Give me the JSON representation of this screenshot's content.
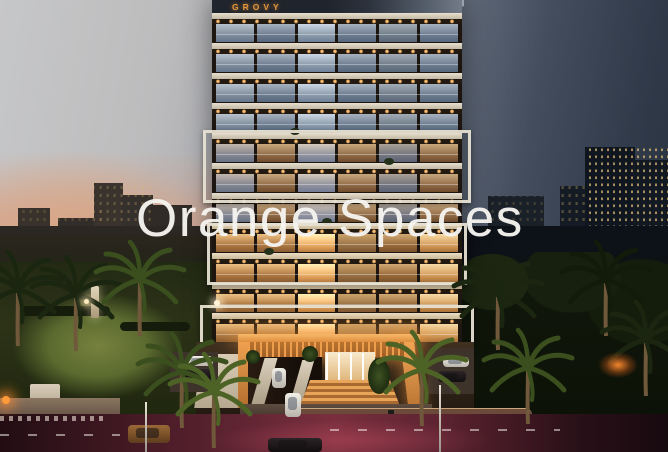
{
  "scene": {
    "description": "Dusk architectural rendering of a residential tower with watermark",
    "watermark": {
      "text": "Orange Spaces",
      "color": "#f6f4f0"
    },
    "building": {
      "sign_text": "GROVY",
      "sign_color": "#e5973c",
      "floor_count": 11,
      "floors": [
        {
          "tone": "cool"
        },
        {
          "tone": "cool"
        },
        {
          "tone": "cool"
        },
        {
          "tone": "cool"
        },
        {
          "tone": "mixed"
        },
        {
          "tone": "mixed"
        },
        {
          "tone": "mixed"
        },
        {
          "tone": "warm"
        },
        {
          "tone": "warm"
        },
        {
          "tone": "warm"
        },
        {
          "tone": "warm"
        }
      ]
    },
    "palette": {
      "sky_light": "#c6c7c9",
      "sky_sunset_glow": "#ebaa73",
      "sky_dark": "#272f3d",
      "facade_slab": "#d9d0bf",
      "balcony_glass_cool": "#84929f",
      "balcony_glass_warm": "#d3a368",
      "accent_warm_light": "#ffbe72",
      "entrance_glow": "#f2a558",
      "park_green": "#5b6a2f",
      "street_glow": "#7a2f3e"
    }
  }
}
